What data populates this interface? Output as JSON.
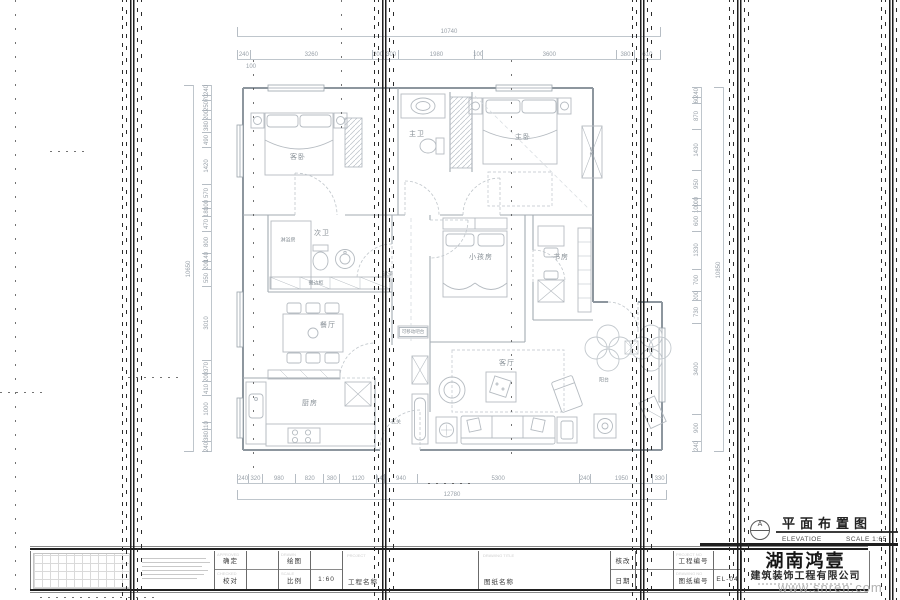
{
  "plan": {
    "rooms": [
      {
        "id": "guest-bedroom",
        "label": "客卧"
      },
      {
        "id": "master-bath",
        "label": "主卫"
      },
      {
        "id": "master-bedroom",
        "label": "主卧"
      },
      {
        "id": "storage-cabinet",
        "label": "储物"
      },
      {
        "id": "second-bath",
        "label": "次卫"
      },
      {
        "id": "shower-room",
        "label": "淋浴房"
      },
      {
        "id": "corridor",
        "label": "过道"
      },
      {
        "id": "kids-room",
        "label": "小孩房"
      },
      {
        "id": "study",
        "label": "书房"
      },
      {
        "id": "sideboard",
        "label": "餐边柜"
      },
      {
        "id": "dining-room",
        "label": "餐厅"
      },
      {
        "id": "movable-bar",
        "label": "可移动吧台"
      },
      {
        "id": "kitchen",
        "label": "厨房"
      },
      {
        "id": "entry",
        "label": "玄关"
      },
      {
        "id": "living-room",
        "label": "客厅"
      },
      {
        "id": "balcony",
        "label": "阳台"
      }
    ]
  },
  "dims": {
    "top": {
      "overall": "10740",
      "segments": [
        "240",
        "3260",
        "200",
        "300",
        "1980",
        "100",
        "3600",
        "380",
        "610"
      ],
      "sub": "100"
    },
    "bottom": {
      "overall": "12780",
      "segments": [
        "240",
        "320",
        "980",
        "820",
        "380",
        "1120",
        "140",
        "940",
        "5300",
        "240",
        "1950",
        "330"
      ]
    },
    "left": {
      "overall": "10650",
      "segments": [
        "240",
        "70",
        "250",
        "200",
        "380",
        "490",
        "1420",
        "570",
        "100",
        "180",
        "470",
        "800",
        "140",
        "200",
        "550",
        "3010",
        "370",
        "200",
        "410",
        "1000",
        "110",
        "380",
        "240"
      ]
    },
    "right": {
      "overall": "10850",
      "segments": [
        "240",
        "60",
        "870",
        "1430",
        "950",
        "100",
        "100",
        "600",
        "1330",
        "700",
        "200",
        "730",
        "3400",
        "900",
        "240"
      ]
    }
  },
  "marker": {
    "ref_letter": "A",
    "title": "平面布置图",
    "type_label": "ELEVATIOE",
    "scale_label": "SCALE 1:65"
  },
  "titleblock": {
    "approved_en": "APPROVED",
    "approved": "确定",
    "checked_en": "CHECKED",
    "checked": "校对",
    "drawn_en": "DRAWN",
    "drawn": "绘图",
    "scale_en": "SCALE",
    "scale": "比例",
    "scale_value": "1:60",
    "project_en": "PROJECT",
    "project": "工程名称",
    "dwg_title_en": "DRAWING TITLE",
    "dwg_title": "图纸名称",
    "revision": "核改",
    "date": "日期",
    "project_no_en": "PROJECT NO",
    "project_no": "工程编号",
    "drawing_no_en": "DRAWING NO",
    "drawing_no": "图纸编号",
    "drawing_no_value": "EL-04",
    "company_name": "湖南鸿壹",
    "company_sub": "建筑装饰工程有限公司"
  },
  "watermark": "www.snren.com"
}
